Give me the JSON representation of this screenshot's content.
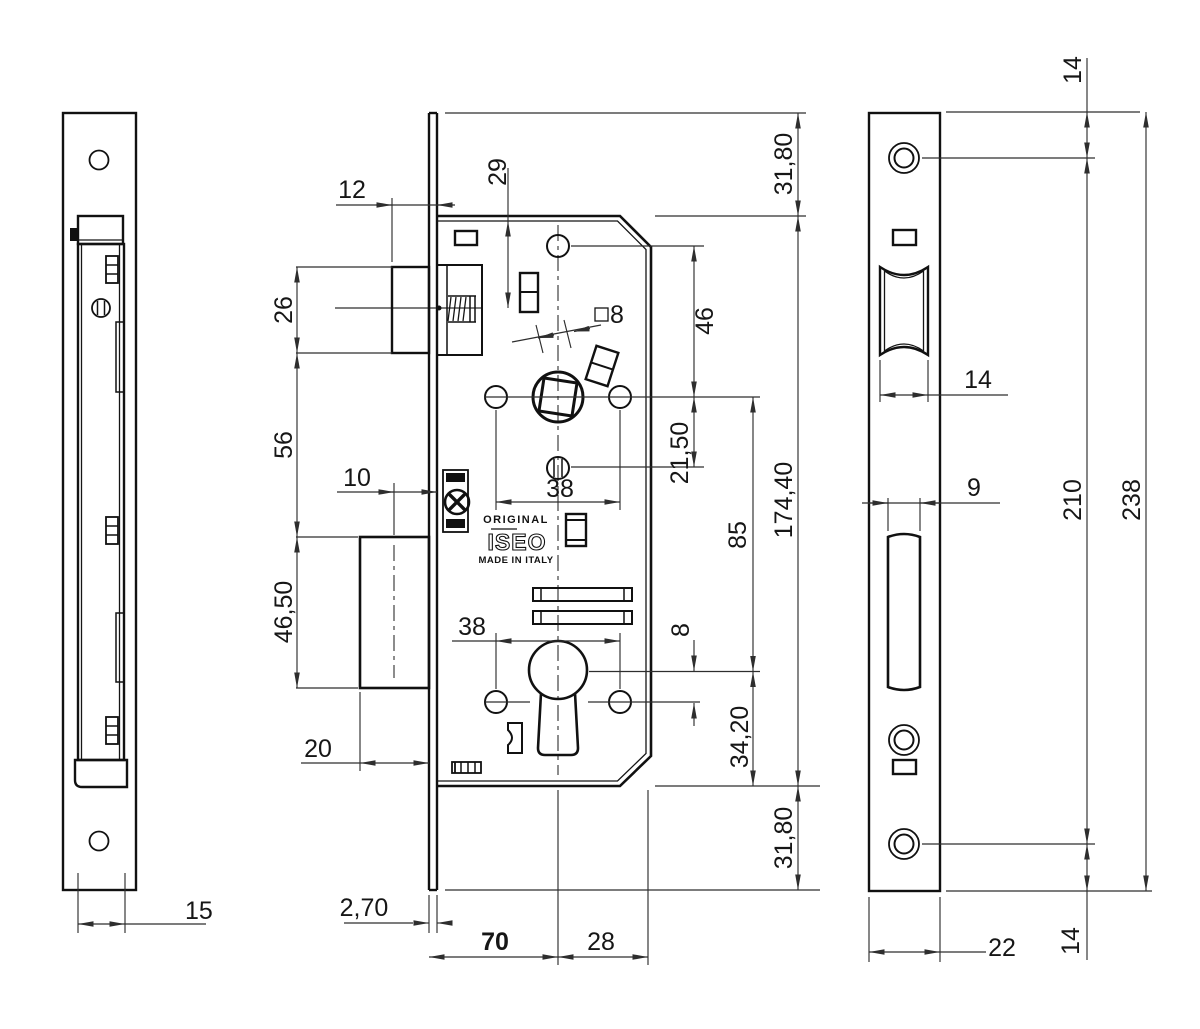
{
  "brand": {
    "original": "ORIGINAL",
    "name": "ISEO",
    "made_in": "MADE IN ITALY"
  },
  "dims": {
    "left_thickness": "15",
    "latch_protrusion": "12",
    "latch_axis_top": "29",
    "square": "8",
    "latch_height": "26",
    "latch_gap": "56",
    "bolt_height": "46,50",
    "bolt_axis_offset": "10",
    "bolt_protrusion": "20",
    "plate_thickness": "2,70",
    "backset": "70",
    "depth": "28",
    "spacing_top": "38",
    "spacing_bottom": "38",
    "top_margin": "31,80",
    "hole_spindle": "46",
    "spindle_screw": "21,50",
    "spindle_cyl": "85",
    "case_height": "174,40",
    "cyl_hole": "8",
    "cyl_bottom": "34,20",
    "bottom_margin": "31,80",
    "fp_top_screw": "14",
    "fp_latch_width": "14",
    "fp_bolt_width": "9",
    "fp_screw_spacing": "210",
    "fp_height": "238",
    "fp_width": "22",
    "fp_bottom_screw": "14"
  }
}
